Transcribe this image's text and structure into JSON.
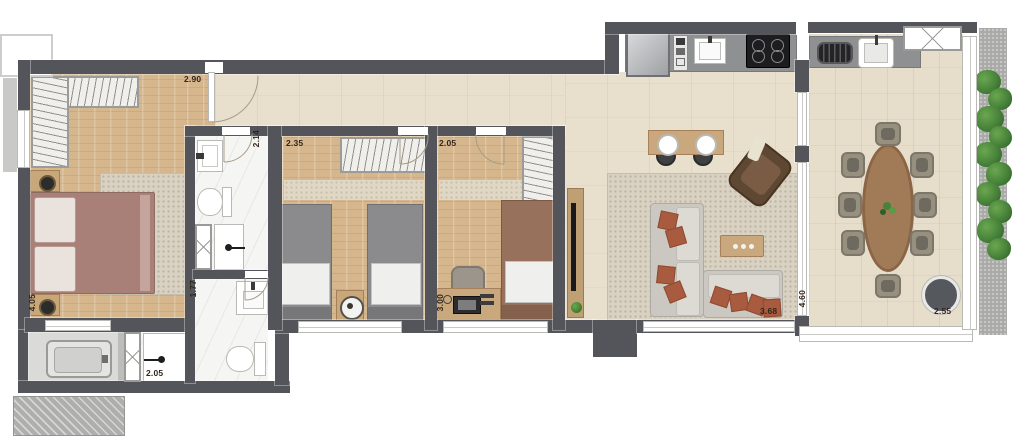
{
  "plan": {
    "type": "apartment-floor-plan",
    "dimension_unit": "m",
    "labels": {
      "master_width": "2.90",
      "master_depth": "4.05",
      "bath_suite_width": "2.14",
      "bedroom2_width": "2.35",
      "bedroom3_width": "2.05",
      "bedroom3_depth": "3.00",
      "bath2_depth": "1.77",
      "bath2_width": "2.05",
      "living_width": "3.68",
      "terrace_depth": "4.60",
      "terrace_width": "2.55"
    },
    "rooms": {
      "master_bedroom": {
        "furniture": [
          "l-shaped-wardrobe",
          "double-bed",
          "nightstand-with-lamp",
          "nightstand-with-lamp",
          "rug"
        ]
      },
      "bath_suite": {
        "furniture": [
          "washbasin",
          "toilet",
          "shower-box"
        ]
      },
      "bath2": {
        "furniture": [
          "vanity-washbasin",
          "toilet",
          "shower-box",
          "bathtub"
        ]
      },
      "bedroom2": {
        "furniture": [
          "wardrobe",
          "single-bed",
          "single-bed",
          "round-side-table"
        ]
      },
      "bedroom3": {
        "furniture": [
          "wardrobe",
          "single-bed",
          "desk",
          "desk-chair"
        ]
      },
      "hall_kitchen": {
        "furniture": [
          "refrigerator",
          "oven-tower",
          "kitchen-sink",
          "cooktop"
        ]
      },
      "living_room": {
        "furniture": [
          "bar-counter",
          "bar-stools",
          "l-shaped-sofa",
          "accent-pillows",
          "coffee-table",
          "armchair",
          "tv-console",
          "rug"
        ]
      },
      "gourmet_terrace": {
        "furniture": [
          "grill",
          "terrace-sink",
          "oval-dining-table",
          "dining-chairs-x8",
          "fire-pit",
          "vertical-garden"
        ]
      }
    },
    "colors": {
      "wall": "#54555A",
      "wood_floor": "#D5B68D",
      "tile_floor": "#E8E0CD",
      "marble_floor": "#F5F5F3",
      "rug": "#D9D2C2",
      "sofa": "#CBC8C2",
      "accent_pillow": "#A85B3F",
      "armchair": "#5E4733",
      "table_wood": "#A17A57",
      "plant_green": "#47823A",
      "counter_gray": "#8F9092"
    }
  }
}
